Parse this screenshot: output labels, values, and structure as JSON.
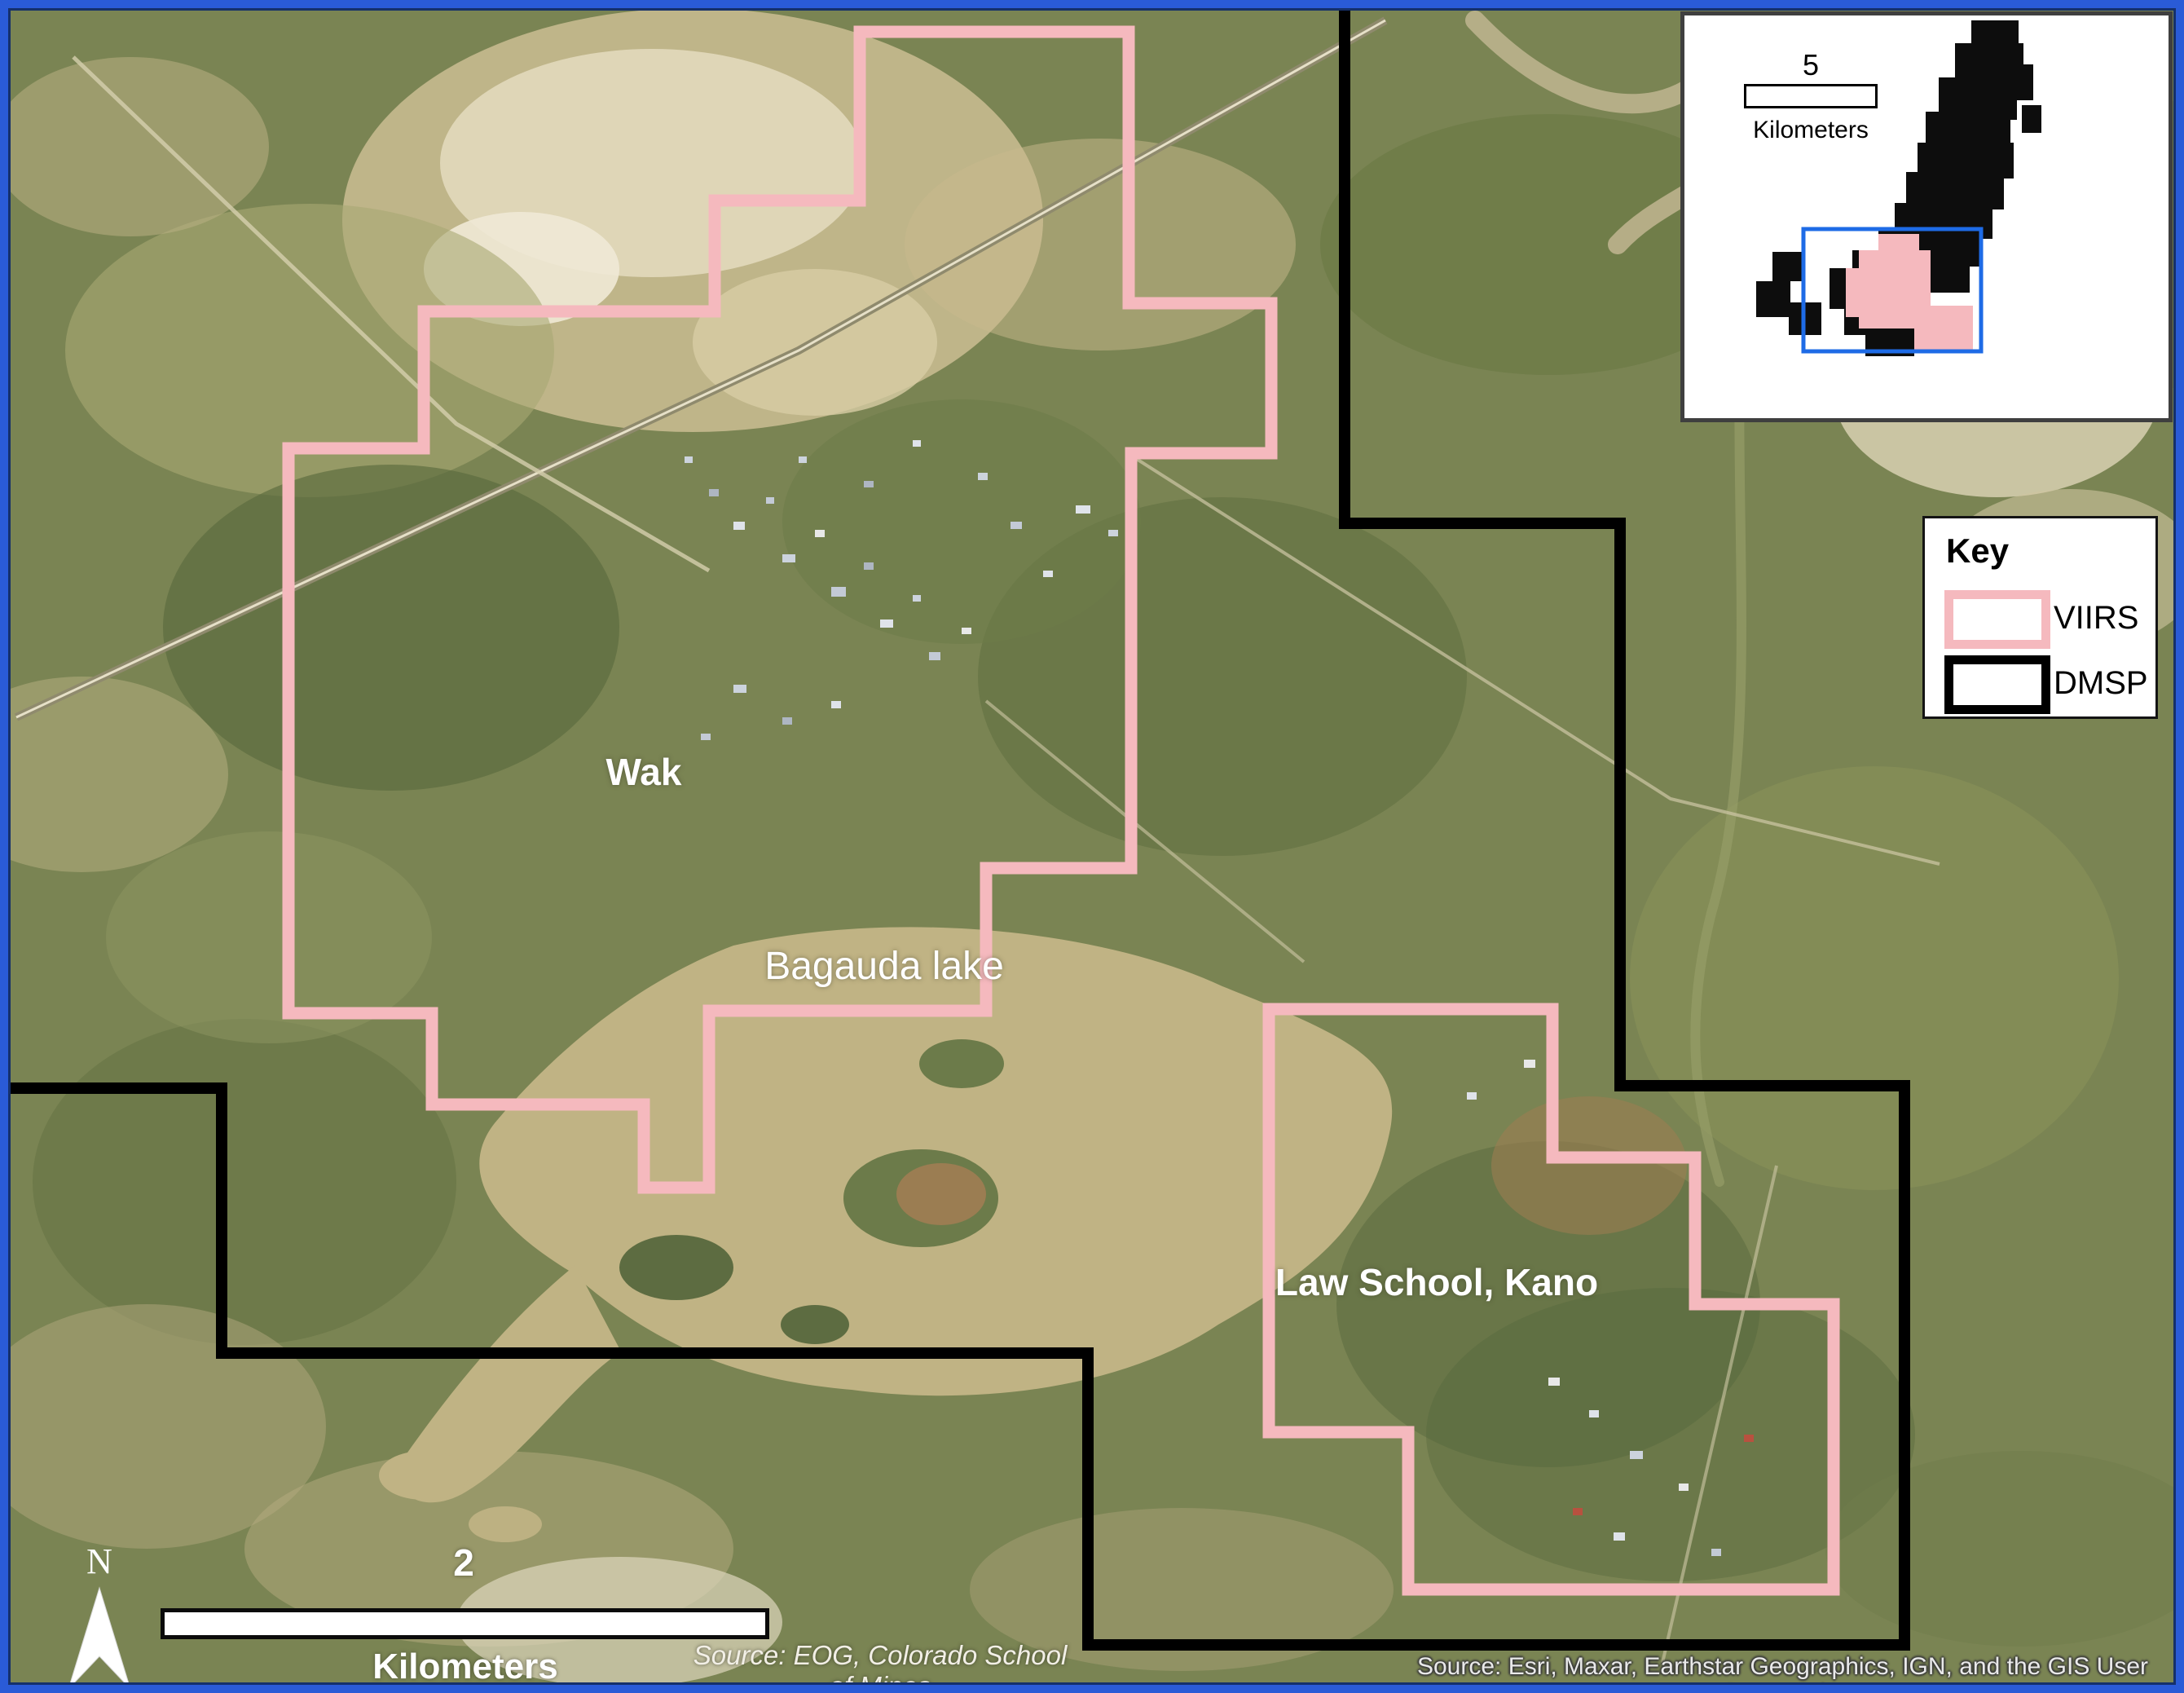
{
  "map": {
    "labels": {
      "wak": "Wak",
      "lake": "Bagauda lake",
      "law_school": "Law School, Kano"
    }
  },
  "key": {
    "title": "Key",
    "items": [
      {
        "label": "VIIRS",
        "color": "#f5b9be"
      },
      {
        "label": "DMSP",
        "color": "#000000"
      }
    ]
  },
  "inset": {
    "scalebar_value": "5",
    "scalebar_unit": "Kilometers",
    "extent_color": "#1e6be6"
  },
  "scalebar": {
    "value": "2",
    "unit": "Kilometers"
  },
  "north_arrow": {
    "label": "N"
  },
  "sources": {
    "nightlights": "Source: EOG, Colorado School of Mines",
    "basemap": "Source: Esri, Maxar, Earthstar Geographics, IGN, and the GIS User Community"
  },
  "colors": {
    "viirs_outline": "#f5b9be",
    "dmsp_outline": "#000000",
    "frame": "#2a5bd7",
    "lake": "#c0b384"
  }
}
